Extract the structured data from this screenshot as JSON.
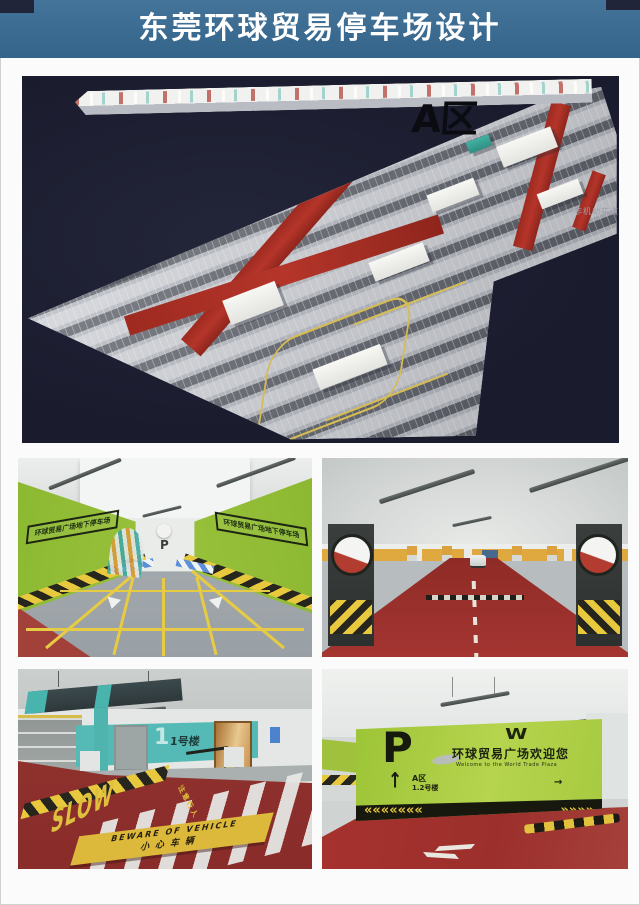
{
  "palette": {
    "banner_blue": "#3b6d94",
    "panel_navy": "#1b1c2f",
    "plan_road_red": "#a82b20",
    "green_wall": "#a3c73e",
    "floor_red": "#9a302c",
    "teal_wall": "#55bab5",
    "hazard_yellow": "#e8c93e"
  },
  "header": {
    "title": "东莞环球贸易停车场设计"
  },
  "plan": {
    "zone_label": "A区",
    "side_label": "非机动车道"
  },
  "photos": {
    "entrance": {
      "left_sign": "环球贸易广场地下停车场",
      "right_sign": "环球贸易广场地下停车场",
      "p_label": "P"
    },
    "building1": {
      "big_numeral": "1",
      "wall_sign": "1号楼",
      "slow_label": "SLOW",
      "caution_label": "注意行人",
      "warning_en": "BEWARE OF VEHICLE",
      "warning_cn": "小心车辆"
    },
    "welcome": {
      "p_label": "P",
      "logo": "W",
      "welcome_cn": "环球贸易广场欢迎您",
      "welcome_en": "Welcome to the World Trade Plaza",
      "up_arrow": "↑",
      "zone_label": "A区",
      "building_label": "1.2号楼",
      "right_arrow": "→",
      "chevrons_left": "«««««««",
      "chevrons_right": "»»»»"
    }
  }
}
